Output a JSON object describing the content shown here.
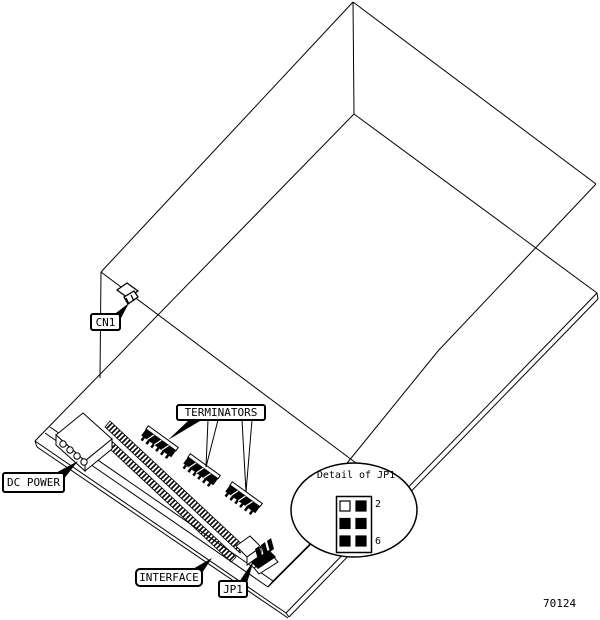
{
  "figure": {
    "id_number": "70124"
  },
  "callouts": {
    "cn1": "CN1",
    "dc_power": "DC POWER",
    "terminators": "TERMINATORS",
    "interface": "INTERFACE",
    "jp1": "JP1"
  },
  "detail": {
    "title": "Detail of JP1",
    "pin_label_top": "2",
    "pin_label_bottom": "6",
    "jumper_grid": {
      "rows": 3,
      "cols": 2,
      "cell_fills": [
        "#ffffff",
        "#000000",
        "#000000",
        "#000000",
        "#000000",
        "#000000"
      ]
    }
  },
  "colors": {
    "line": "#000000",
    "background": "#ffffff"
  }
}
